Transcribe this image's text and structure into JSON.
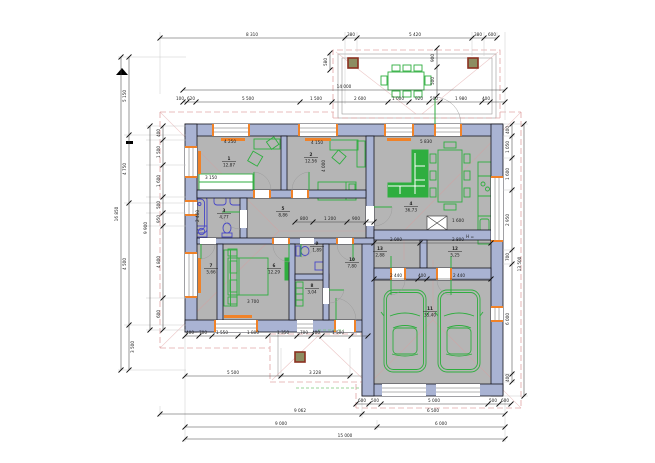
{
  "meta": {
    "type": "architectural-floor-plan",
    "storey": "ground floor with double garage and terrace"
  },
  "colors": {
    "wall_fill": "#a9b3d3",
    "wall_stroke": "#15151f",
    "room_fill": "#b5b5b5",
    "furniture_green": "#2fae3f",
    "sanitary_blue": "#4747c7",
    "window_orange": "#f08228",
    "roof_pink": "#dd9a9a",
    "dim_color": "#444444",
    "post_border": "#8b3020",
    "post_fill": "#8d8d62",
    "door_green": "#2fae3f"
  },
  "rooms": [
    {
      "num": "1",
      "area": "12,87",
      "x": 229,
      "y": 160
    },
    {
      "num": "2",
      "area": "12,56",
      "x": 311,
      "y": 156
    },
    {
      "num": "3",
      "area": "4,77",
      "x": 224,
      "y": 212
    },
    {
      "num": "4",
      "area": "36,73",
      "x": 411,
      "y": 205
    },
    {
      "num": "5",
      "area": "8,86",
      "x": 283,
      "y": 210
    },
    {
      "num": "6",
      "area": "12,29",
      "x": 274,
      "y": 267
    },
    {
      "num": "7",
      "area": "5,66",
      "x": 211,
      "y": 267
    },
    {
      "num": "8",
      "area": "3,04",
      "x": 312,
      "y": 287
    },
    {
      "num": "9",
      "area": "1,89",
      "x": 317,
      "y": 245
    },
    {
      "num": "10",
      "area": "7,80",
      "x": 352,
      "y": 261
    },
    {
      "num": "11",
      "area": "35,40",
      "x": 430,
      "y": 310
    },
    {
      "num": "12",
      "area": "5,25",
      "x": 455,
      "y": 250
    },
    {
      "num": "13",
      "area": "2,88",
      "x": 380,
      "y": 250
    }
  ],
  "dimensions": [
    {
      "t": "8 310",
      "x": 252,
      "y": 36
    },
    {
      "t": "380",
      "x": 351,
      "y": 36
    },
    {
      "t": "5 420",
      "x": 415,
      "y": 36
    },
    {
      "t": "380",
      "x": 478,
      "y": 36
    },
    {
      "t": "600",
      "x": 492,
      "y": 36
    },
    {
      "t": "14 000",
      "x": 344,
      "y": 88
    },
    {
      "t": "100",
      "x": 180,
      "y": 100
    },
    {
      "t": "620",
      "x": 191,
      "y": 100
    },
    {
      "t": "5 500",
      "x": 248,
      "y": 100
    },
    {
      "t": "1 500",
      "x": 316,
      "y": 100
    },
    {
      "t": "2 600",
      "x": 360,
      "y": 100
    },
    {
      "t": "1 000",
      "x": 398,
      "y": 100
    },
    {
      "t": "920",
      "x": 419,
      "y": 100
    },
    {
      "t": "500",
      "x": 434,
      "y": 100
    },
    {
      "t": "1 980",
      "x": 461,
      "y": 100
    },
    {
      "t": "400",
      "x": 486,
      "y": 100
    },
    {
      "t": "580",
      "x": 327,
      "y": 62,
      "r": -90
    },
    {
      "t": "900",
      "x": 434,
      "y": 58,
      "r": -90
    },
    {
      "t": "500",
      "x": 434,
      "y": 81,
      "r": -90
    },
    {
      "t": "16 850",
      "x": 118,
      "y": 214,
      "r": -90
    },
    {
      "t": "5 150",
      "x": 126,
      "y": 96,
      "r": -90
    },
    {
      "t": "4 750",
      "x": 126,
      "y": 169,
      "r": -90
    },
    {
      "t": "4 500",
      "x": 126,
      "y": 264,
      "r": -90
    },
    {
      "t": "3 500",
      "x": 134,
      "y": 347,
      "r": -90
    },
    {
      "t": "9 900",
      "x": 147,
      "y": 228,
      "r": -90
    },
    {
      "t": "400",
      "x": 160,
      "y": 133,
      "r": -90
    },
    {
      "t": "1 500",
      "x": 160,
      "y": 152,
      "r": -90
    },
    {
      "t": "1 600",
      "x": 160,
      "y": 181,
      "r": -90
    },
    {
      "t": "500",
      "x": 160,
      "y": 205,
      "r": -90
    },
    {
      "t": "950",
      "x": 160,
      "y": 219,
      "r": -90
    },
    {
      "t": "4 800",
      "x": 160,
      "y": 262,
      "r": -90
    },
    {
      "t": "600",
      "x": 160,
      "y": 314,
      "r": -90
    },
    {
      "t": "400",
      "x": 509,
      "y": 130,
      "r": -90
    },
    {
      "t": "1 050",
      "x": 509,
      "y": 147,
      "r": -90
    },
    {
      "t": "1 600",
      "x": 509,
      "y": 174,
      "r": -90
    },
    {
      "t": "2 950",
      "x": 509,
      "y": 220,
      "r": -90
    },
    {
      "t": "700",
      "x": 509,
      "y": 257,
      "r": -90
    },
    {
      "t": "6 000",
      "x": 509,
      "y": 319,
      "r": -90
    },
    {
      "t": "400",
      "x": 509,
      "y": 378,
      "r": -90
    },
    {
      "t": "13 500",
      "x": 521,
      "y": 264,
      "r": -90
    },
    {
      "t": "600",
      "x": 362,
      "y": 402
    },
    {
      "t": "500",
      "x": 375,
      "y": 402
    },
    {
      "t": "5 000",
      "x": 434,
      "y": 402
    },
    {
      "t": "500",
      "x": 493,
      "y": 402
    },
    {
      "t": "600",
      "x": 505,
      "y": 402
    },
    {
      "t": "9 062",
      "x": 300,
      "y": 412
    },
    {
      "t": "6 500",
      "x": 433,
      "y": 412
    },
    {
      "t": "9 000",
      "x": 281,
      "y": 425
    },
    {
      "t": "6 000",
      "x": 441,
      "y": 425
    },
    {
      "t": "15 000",
      "x": 345,
      "y": 437
    },
    {
      "t": "400",
      "x": 190,
      "y": 334
    },
    {
      "t": "700",
      "x": 203,
      "y": 334
    },
    {
      "t": "1 550",
      "x": 222,
      "y": 334
    },
    {
      "t": "1 800",
      "x": 253,
      "y": 334
    },
    {
      "t": "1 350",
      "x": 283,
      "y": 334
    },
    {
      "t": "700",
      "x": 304,
      "y": 334
    },
    {
      "t": "400",
      "x": 316,
      "y": 334
    },
    {
      "t": "1 500",
      "x": 338,
      "y": 334
    },
    {
      "t": "5 500",
      "x": 233,
      "y": 374
    },
    {
      "t": "3 228",
      "x": 315,
      "y": 374
    },
    {
      "t": "4 250",
      "x": 230,
      "y": 143
    },
    {
      "t": "3 150",
      "x": 211,
      "y": 179
    },
    {
      "t": "4 150",
      "x": 317,
      "y": 144
    },
    {
      "t": "5 830",
      "x": 426,
      "y": 143
    },
    {
      "t": "2 400",
      "x": 199,
      "y": 216,
      "r": -90
    },
    {
      "t": "4 000",
      "x": 325,
      "y": 166,
      "r": -90
    },
    {
      "t": "1 600",
      "x": 458,
      "y": 222
    },
    {
      "t": "H =",
      "x": 470,
      "y": 238
    },
    {
      "t": "800",
      "x": 304,
      "y": 220
    },
    {
      "t": "1 200",
      "x": 330,
      "y": 220
    },
    {
      "t": "900",
      "x": 356,
      "y": 220
    },
    {
      "t": "2 000",
      "x": 396,
      "y": 241
    },
    {
      "t": "2 800",
      "x": 458,
      "y": 241
    },
    {
      "t": "2 440",
      "x": 396,
      "y": 277
    },
    {
      "t": "400",
      "x": 422,
      "y": 277
    },
    {
      "t": "2 440",
      "x": 459,
      "y": 277
    },
    {
      "t": "3 700",
      "x": 253,
      "y": 303
    }
  ]
}
